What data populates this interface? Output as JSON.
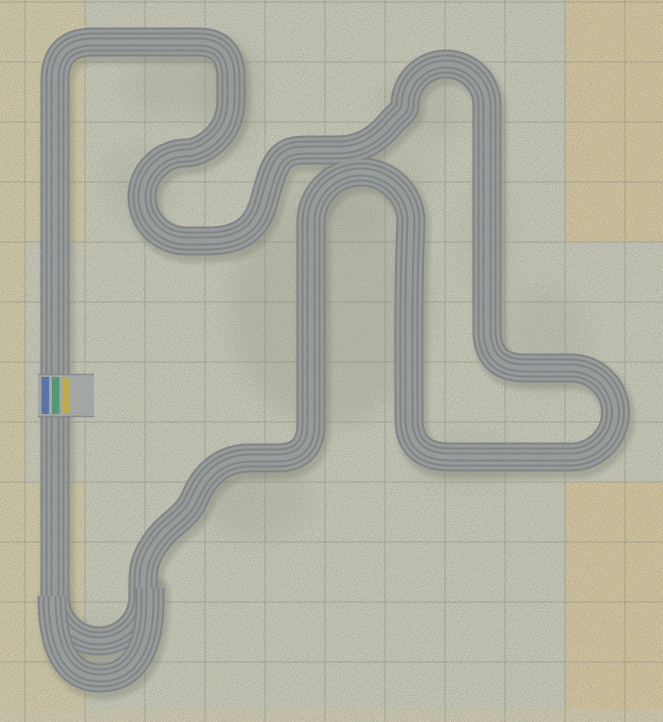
{
  "scene": {
    "width": 663,
    "height": 722,
    "bg": "#e3e6d6"
  },
  "tiles": {
    "palette": {
      "g": "#e3e6d6",
      "b": "#f3e6bb",
      "o": "#f8dfa8"
    },
    "col_edges": [
      0,
      25,
      85,
      145,
      205,
      265,
      325,
      385,
      445,
      505,
      565,
      625,
      663
    ],
    "row_edges": [
      0,
      62,
      122,
      182,
      242,
      302,
      362,
      422,
      482,
      542,
      602,
      662,
      722
    ],
    "rows": [
      "bbggggggggoo",
      "bbggggggggoo",
      "bbggggggggoo",
      "bbggggggggoo",
      "bggggggggggg",
      "bggggggggggg",
      "bggggggggggg",
      "bggggggggggg",
      "bbggggggggoo",
      "bbggggggggoo",
      "bbggggggggoo",
      "bbggggggggoo"
    ],
    "bottom_strip": {
      "y": 710,
      "h": 12,
      "color": "#f0e7c6",
      "opacity": 0.85
    }
  },
  "grid": {
    "x_lines": [
      25,
      85,
      145,
      205,
      265,
      325,
      385,
      445,
      505,
      565,
      625
    ],
    "y_lines": [
      2,
      62,
      122,
      182,
      242,
      302,
      362,
      422,
      482,
      542,
      602,
      662
    ],
    "color": "#7d8278",
    "opacity": 0.5,
    "width": 1
  },
  "smudges": [
    {
      "cx": 330,
      "cy": 310,
      "rx": 100,
      "ry": 115,
      "o": 0.16
    },
    {
      "cx": 360,
      "cy": 185,
      "rx": 70,
      "ry": 40,
      "o": 0.12
    },
    {
      "cx": 232,
      "cy": 95,
      "rx": 28,
      "ry": 55,
      "o": 0.16
    },
    {
      "cx": 180,
      "cy": 85,
      "rx": 55,
      "ry": 35,
      "o": 0.12
    },
    {
      "cx": 140,
      "cy": 185,
      "rx": 35,
      "ry": 40,
      "o": 0.1
    },
    {
      "cx": 420,
      "cy": 110,
      "rx": 45,
      "ry": 35,
      "o": 0.12
    },
    {
      "cx": 255,
      "cy": 495,
      "rx": 55,
      "ry": 45,
      "o": 0.13
    },
    {
      "cx": 465,
      "cy": 462,
      "rx": 55,
      "ry": 25,
      "o": 0.12
    },
    {
      "cx": 545,
      "cy": 340,
      "rx": 45,
      "ry": 55,
      "o": 0.1
    },
    {
      "cx": 88,
      "cy": 645,
      "rx": 45,
      "ry": 28,
      "o": 0.12
    },
    {
      "cx": 487,
      "cy": 240,
      "rx": 30,
      "ry": 60,
      "o": 0.08
    }
  ],
  "track": {
    "edge_color": "#6b7584",
    "lane_color": "#98a1af",
    "inner_lane_color": "#9aa3b1",
    "layers": [
      {
        "w": 29,
        "k": "edge"
      },
      {
        "w": 25,
        "k": "lane"
      },
      {
        "w": 19,
        "k": "edge"
      },
      {
        "w": 15,
        "k": "lane"
      },
      {
        "w": 9,
        "k": "edge"
      },
      {
        "w": 5,
        "k": "inner"
      }
    ],
    "shadow": {
      "color": "#3c4238",
      "opacity": 0.28,
      "w": 33,
      "dx": 3,
      "dy": 5
    },
    "main_path": "M 55 598 L 55 80 Q 55 42 93 42 L 198 42 Q 231 42 231 78 L 231 98 C 231 122 222 136 205 147 C 196 152 191 153 186 153 A 44 44 0 0 0 186 241 L 208 241 C 240 241 256 228 263 205 C 268 188 272 168 281 158 C 289 150 298 150 310 150 L 338 150 C 362 150 378 138 390 124 C 398 114 405 112 405 105 A 41 41 0 0 1 487 105 L 487 330 Q 487 368 525 368 L 571 368 A 44.5 44.5 0 0 1 571 457 L 450 457 Q 409 457 409 419 L 409 415 C 409 350 408 290 411 222 A 50 50 0 0 0 311 222 L 311 424 Q 311 458 277 458 L 250 458 C 230 458 216 466 205 480 C 194 494 196 502 184 514 C 172 526 166 528 156 542 C 146 556 143 566 143 582 L 143 596 A 44 44 0 0 1 55 598 Z",
    "crossover_path": "M 52 596 C 52 646 66 678 100 678 C 134 678 150 648 150 602 L 150 588"
  },
  "start_finish": {
    "apron": {
      "x": 38,
      "y": 374,
      "w": 56,
      "h": 43,
      "color": "#b2b9c4"
    },
    "seam_color": "#6b7584",
    "stripe_y": 377,
    "stripe_h": 37,
    "stripes": [
      {
        "name": "blue-lane-stripe",
        "x": 41.5,
        "w": 7.5,
        "color": "#2253c6"
      },
      {
        "name": "green-lane-stripe",
        "x": 52,
        "w": 7.5,
        "color": "#169a60"
      },
      {
        "name": "yellow-lane-stripe",
        "x": 62.5,
        "w": 7,
        "color": "#e4c316"
      }
    ]
  },
  "noise": {
    "opacity": 0.35,
    "frequency": 0.85
  }
}
